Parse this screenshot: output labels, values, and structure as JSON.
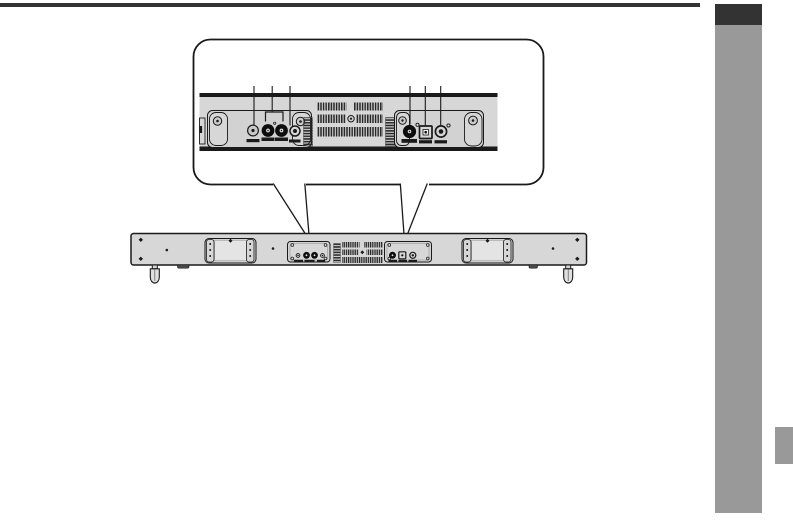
{
  "page": {
    "kind": "user-manual-page-excerpt",
    "visible_text": "",
    "decor": {
      "top_rule_color": "#333333",
      "chapter_tab_dark_color": "#333333",
      "chapter_tab_gray_color": "#999999",
      "side_marker_color": "#999999"
    }
  },
  "colors": {
    "page_bg": "#ffffff",
    "line": "#1a1a1a",
    "panel_fill": "#d7d7d7",
    "panel_deep": "#d2d2d2",
    "panel_inner": "#e4e4e4",
    "connector_dark": "#0d0d0d"
  },
  "figure": {
    "description_kind": "soundbar-rear-panel-connection-diagram",
    "callout": {
      "shape": "rounded-rectangle-magnifier",
      "left_group": {
        "leader_line_count": 3,
        "icons": [
          "screw-jack-icon",
          "rca-jack-bracket-icon",
          "rca-jack-icon",
          "rca-jack-icon",
          "mini-jack-icon"
        ]
      },
      "right_group": {
        "leader_line_count": 3,
        "icons": [
          "coaxial-jack-icon",
          "optical-port-icon",
          "round-jack-icon"
        ]
      },
      "other_icons": [
        "vent-grille-icon",
        "heat-fin-icon",
        "corner-bracket-screw-icon"
      ]
    },
    "device": {
      "view": "rear",
      "elements": [
        "wall-mount-recess-left",
        "wall-mount-recess-right",
        "connector-panel-left",
        "connector-panel-right",
        "vent-grille",
        "screw-icons",
        "foot-left",
        "foot-right",
        "leader-v-left",
        "leader-v-right"
      ]
    }
  }
}
